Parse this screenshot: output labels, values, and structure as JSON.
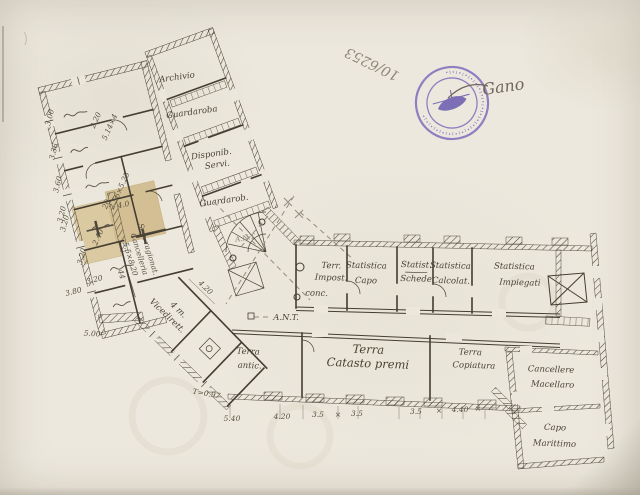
{
  "document_colors": {
    "paper": "#e9e5da",
    "ink": "#453e32",
    "pencil": "#8f8779",
    "patch": "#d6c294",
    "stamp_purple": "#7c6abc"
  },
  "marks": {
    "file_number": "10/6253",
    "signature": "Gano",
    "stamp_ring": "∙ı∙ı∙ı∙ı∙ı∙ı∙ı∙ı∙ı∙ı∙ı∙ı∙ı∙ı∙ı∙ı∙ı∙ı∙ı∙ı∙ı∙"
  },
  "plan": {
    "rooms": {
      "archivio": "Archivio",
      "guardaroba_top": "Guardaroba",
      "disponib_l1": "Disponib.",
      "disponib_l2": "Servi.",
      "guardaroba_mid": "Guardarob.",
      "terr_impost_l1": "Terr.",
      "terr_impost_l2": "Impost.",
      "terr_impost_l3": "conc.",
      "statistica_capo_l1": "Statistica",
      "statistica_capo_l2": "Capo",
      "statist_schede_l1": "Statist.",
      "statist_schede_l2": "Schede",
      "statistica_calcolat_l1": "Statistica",
      "statistica_calcolat_l2": "Calcolat.",
      "statistica_impiegati_l1": "Statistica",
      "statistica_impiegati_l2": "Impiegati",
      "terra_antic_l1": "Terra",
      "terra_antic_l2": "antic.",
      "terra_catasto_l1": "Terra",
      "terra_catasto_l2": "Catasto premi",
      "terra_copiatura_l1": "Terra",
      "terra_copiatura_l2": "Copiatura",
      "cancellere_l1": "Cancellere",
      "cancellere_l2": "Macellaro",
      "capo_marittimo_l1": "Capo",
      "capo_marittimo_l2": "Marittimo",
      "vicedirett_l1": "4 m.",
      "vicedirett_l2": "Vicedirett."
    },
    "annotations": {
      "ant_upper": "A.N.T.",
      "ant_lower": "A.N.T.",
      "t_value": "T=0.97",
      "note_l1": "Seg. ragionat.",
      "note_l2": "Cancelleria",
      "note_l3": "5.5×8.20",
      "note_l4": "44",
      "dim_diag": "4.20"
    },
    "dims": {
      "bottom": [
        "5.40",
        "4.20",
        "3.5",
        "3.5",
        "3.5",
        "4.40"
      ],
      "bottom_seps": [
        "×",
        "×",
        "×",
        "‥"
      ],
      "left_chain": [
        "3.00",
        "3.36",
        "3.60",
        "3.20"
      ],
      "patch": [
        "3.20",
        "3.20",
        "4.0"
      ],
      "below_patch": "3.20",
      "d380": "3.80",
      "d500": "5.00",
      "wing": [
        "2.20",
        "5.14×4",
        "2.56×5.25",
        "20",
        "2.40"
      ]
    }
  }
}
